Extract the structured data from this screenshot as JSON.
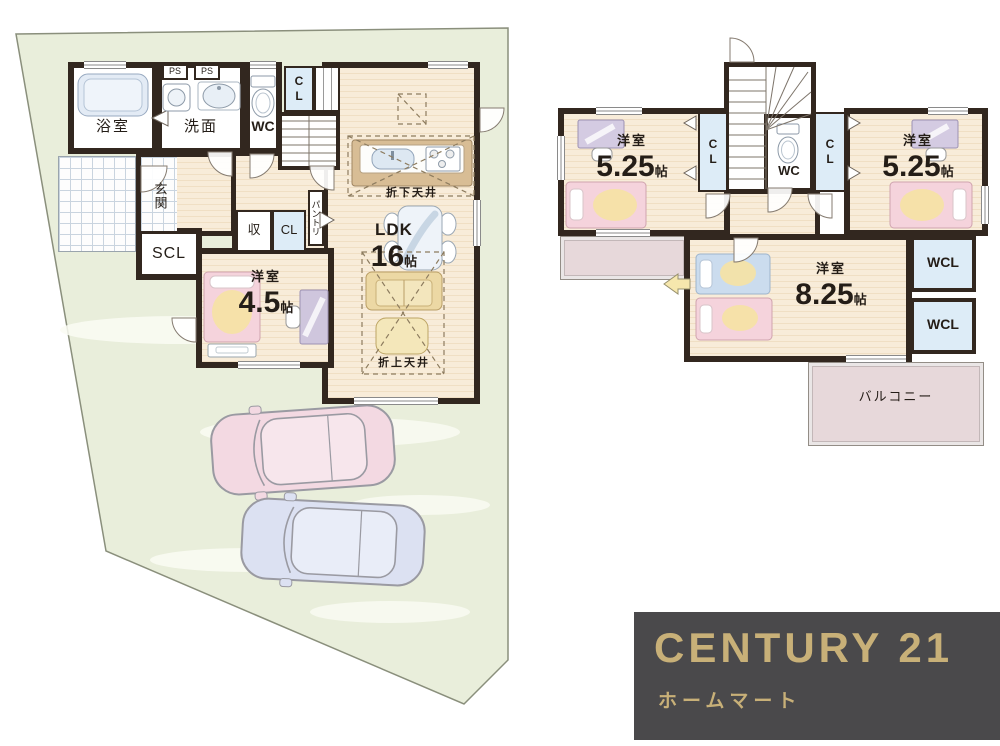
{
  "floor1": {
    "bath": "浴室",
    "ps1": "PS",
    "ps2": "PS",
    "wash": "洗面",
    "wc": "WC",
    "cl_top": "CL",
    "genkan": "玄関",
    "scl": "SCL",
    "storage": "収",
    "cl_hall": "CL",
    "pantry": "パントリ",
    "room45": {
      "type": "洋室",
      "size": "4.5",
      "unit": "帖"
    },
    "ldk": {
      "type": "LDK",
      "size": "16",
      "unit": "帖"
    },
    "lowered_ceiling": "折下天井",
    "raised_ceiling": "折上天井"
  },
  "floor2": {
    "room_left": {
      "type": "洋室",
      "size": "5.25",
      "unit": "帖"
    },
    "room_right": {
      "type": "洋室",
      "size": "5.25",
      "unit": "帖"
    },
    "room_back": {
      "type": "洋室",
      "size": "8.25",
      "unit": "帖"
    },
    "cl_left": "CL",
    "cl_right": "CL",
    "wc": "WC",
    "wcl_top": "WCL",
    "wcl_bottom": "WCL",
    "balcony": "バルコニー"
  },
  "logo": {
    "brand": "CENTURY 21",
    "company": "ホームマート"
  },
  "icons": [
    "bathtub-icon",
    "washer-icon",
    "sink-icon",
    "toilet-icon",
    "kitchen-counter-icon",
    "stove-icon",
    "dining-table-icon",
    "sofa-icon",
    "coffee-table-icon",
    "bed-icon",
    "desk-icon",
    "stairs-icon",
    "door-swing-icon",
    "car-icon",
    "closet-arrow-icon",
    "entry-arrow-icon"
  ],
  "colors": {
    "wall": "#32271f",
    "site": "#e9eedb",
    "floor": "#f8ecd9",
    "closet": "#ddecf7",
    "balcony": "#e7d8da",
    "logo_bg": "#4a494b",
    "gold": "#c8b078"
  }
}
